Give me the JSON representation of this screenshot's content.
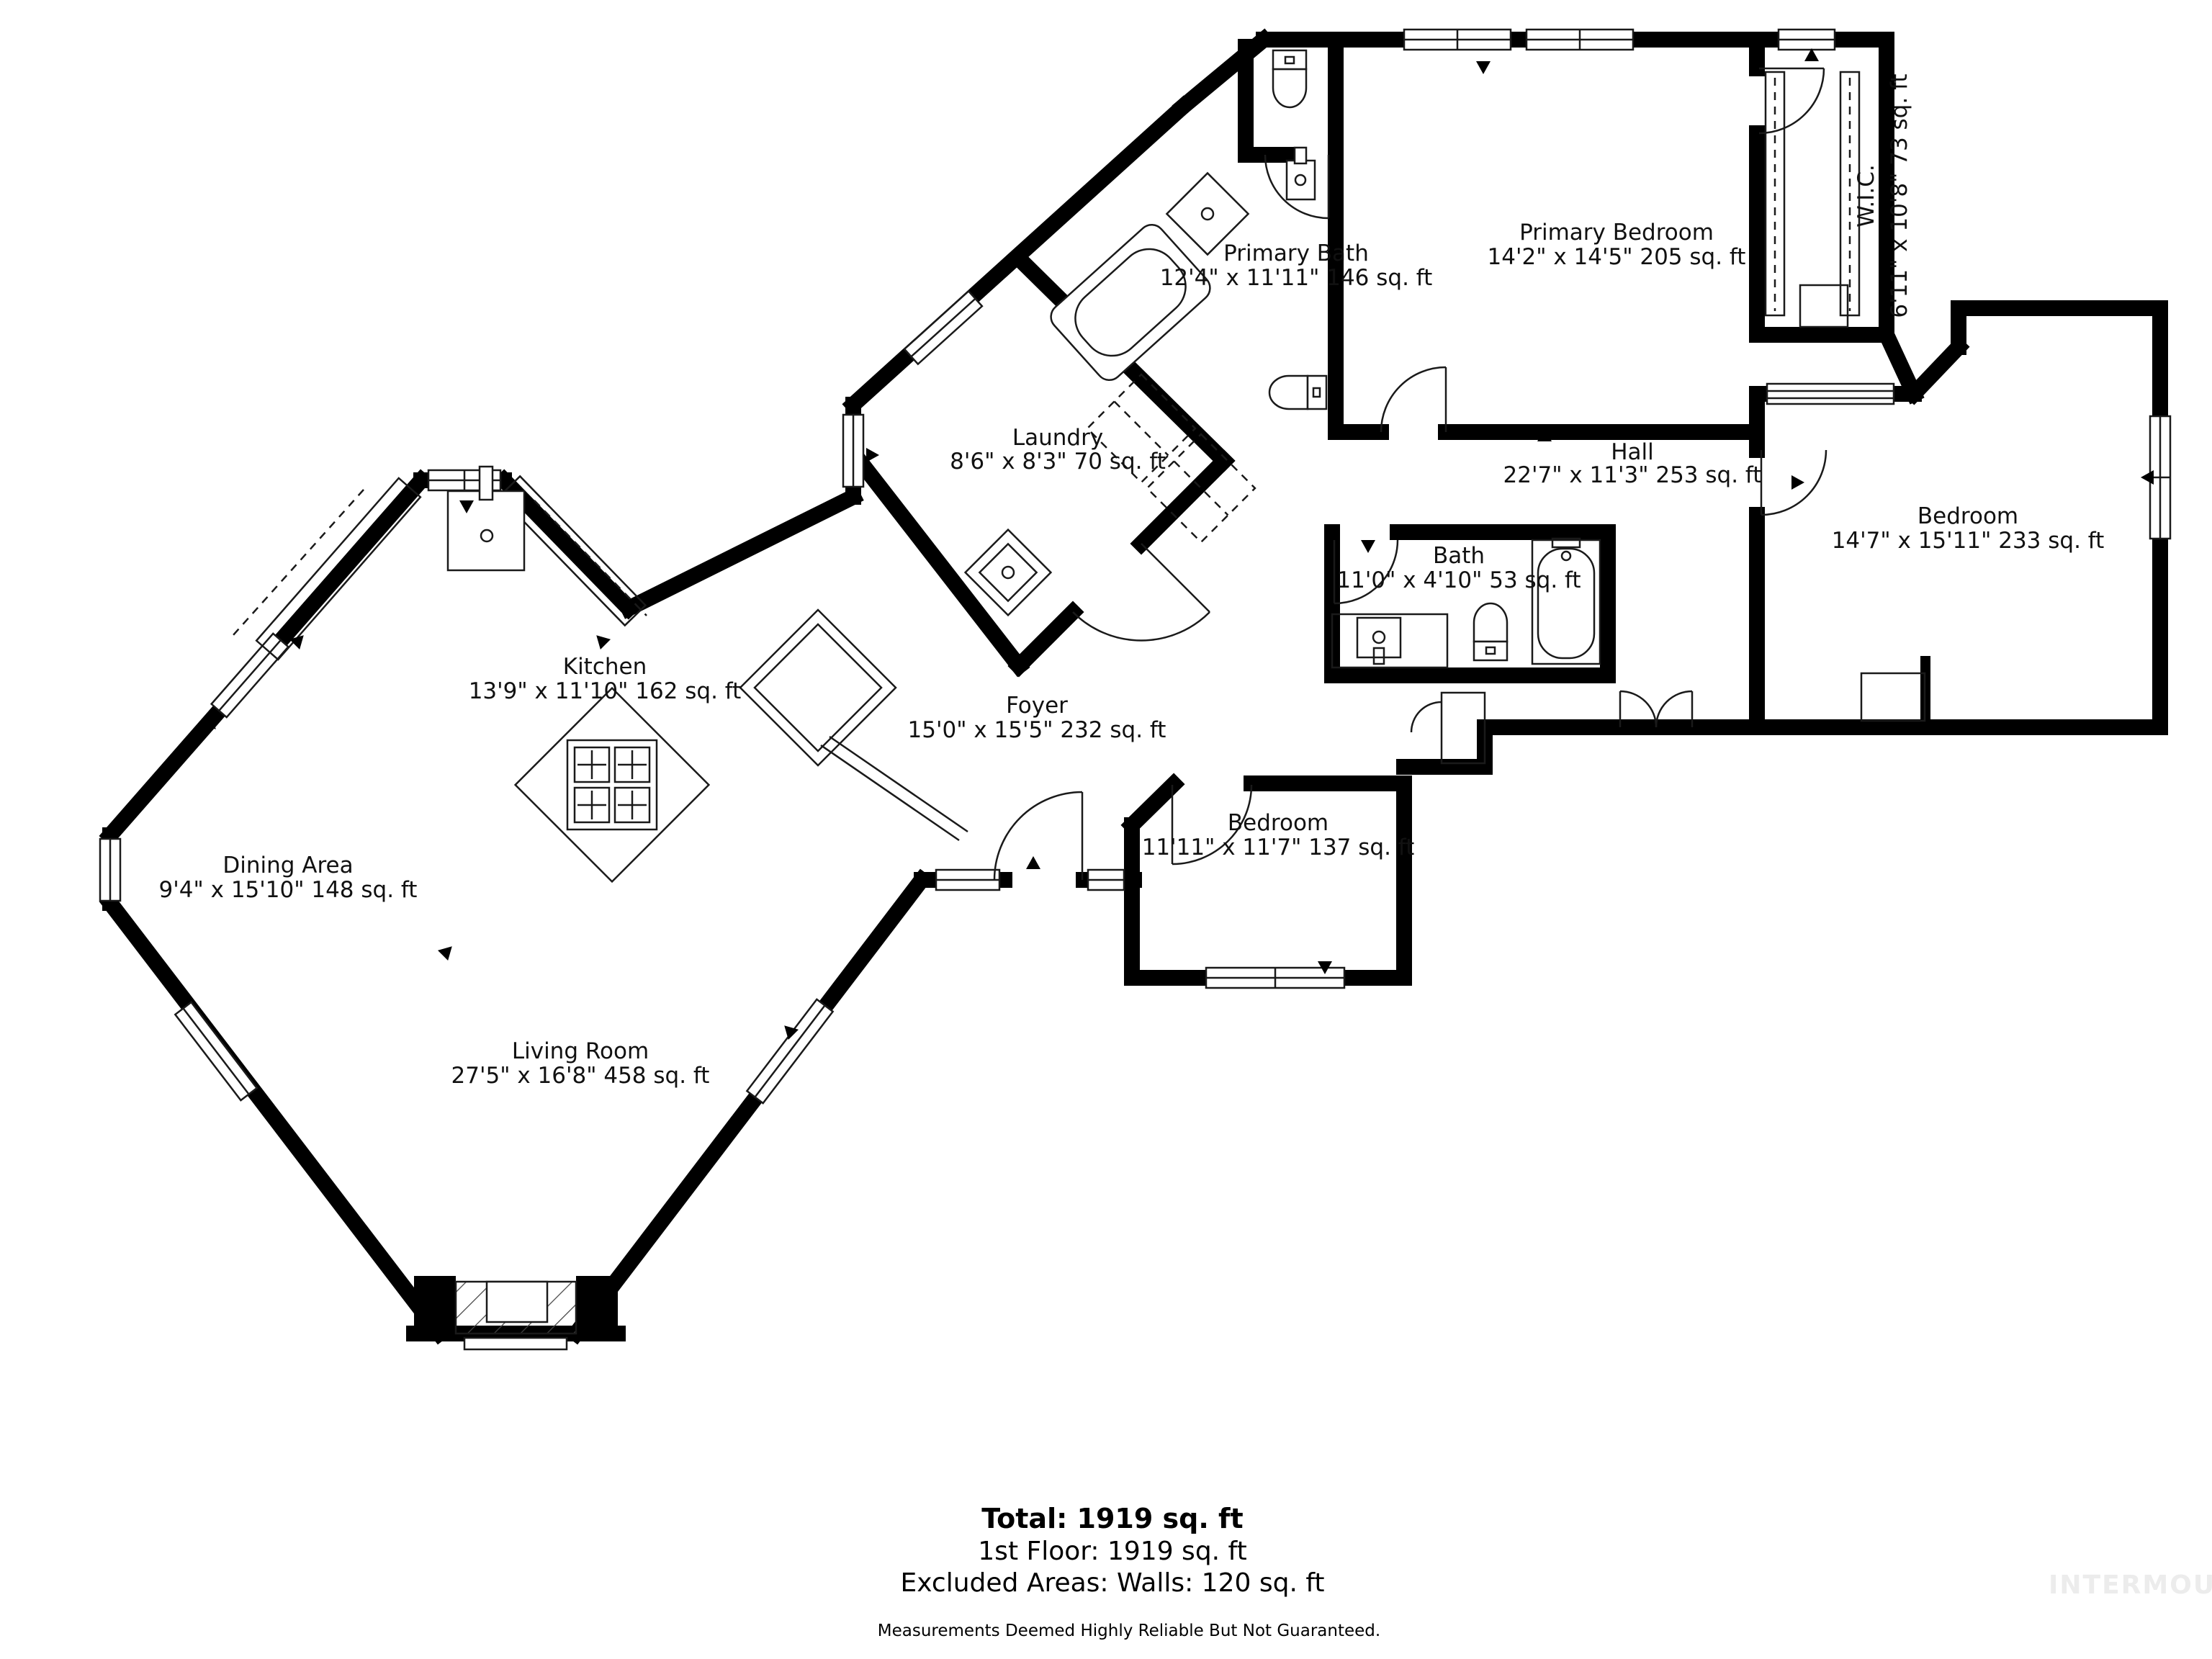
{
  "floor_plan": {
    "wall_color": "#000000",
    "text_color": "#111111",
    "rooms": [
      {
        "id": "primary-bath",
        "name": "Primary Bath",
        "dims": "12'4\" x 11'11\" 146 sq. ft"
      },
      {
        "id": "primary-bedroom",
        "name": "Primary Bedroom",
        "dims": "14'2\" x 14'5\" 205 sq. ft"
      },
      {
        "id": "wic",
        "name": "W.I.C.",
        "dims": "6'11\" x 10'8\" 73 sq. ft"
      },
      {
        "id": "laundry",
        "name": "Laundry",
        "dims": "8'6\" x 8'3\" 70 sq. ft"
      },
      {
        "id": "hall",
        "name": "Hall",
        "dims": "22'7\" x 11'3\" 253 sq. ft"
      },
      {
        "id": "bedroom-right",
        "name": "Bedroom",
        "dims": "14'7\" x 15'11\" 233 sq. ft"
      },
      {
        "id": "bath",
        "name": "Bath",
        "dims": "11'0\" x 4'10\" 53 sq. ft"
      },
      {
        "id": "kitchen",
        "name": "Kitchen",
        "dims": "13'9\" x 11'10\" 162 sq. ft"
      },
      {
        "id": "foyer",
        "name": "Foyer",
        "dims": "15'0\" x 15'5\" 232 sq. ft"
      },
      {
        "id": "dining",
        "name": "Dining Area",
        "dims": "9'4\" x 15'10\" 148 sq. ft"
      },
      {
        "id": "bedroom-bottom",
        "name": "Bedroom",
        "dims": "11'11\" x 11'7\" 137 sq. ft"
      },
      {
        "id": "living",
        "name": "Living Room",
        "dims": "27'5\" x 16'8\" 458 sq. ft"
      }
    ],
    "summary": {
      "total": "Total: 1919 sq. ft",
      "first_floor": "1st Floor: 1919 sq. ft",
      "excluded": "Excluded Areas: Walls: 120 sq. ft",
      "disclaimer": "Measurements Deemed Highly Reliable But Not Guaranteed."
    },
    "watermark": {
      "text": "INTERMOUNTAIN",
      "color": "#ececec"
    }
  }
}
